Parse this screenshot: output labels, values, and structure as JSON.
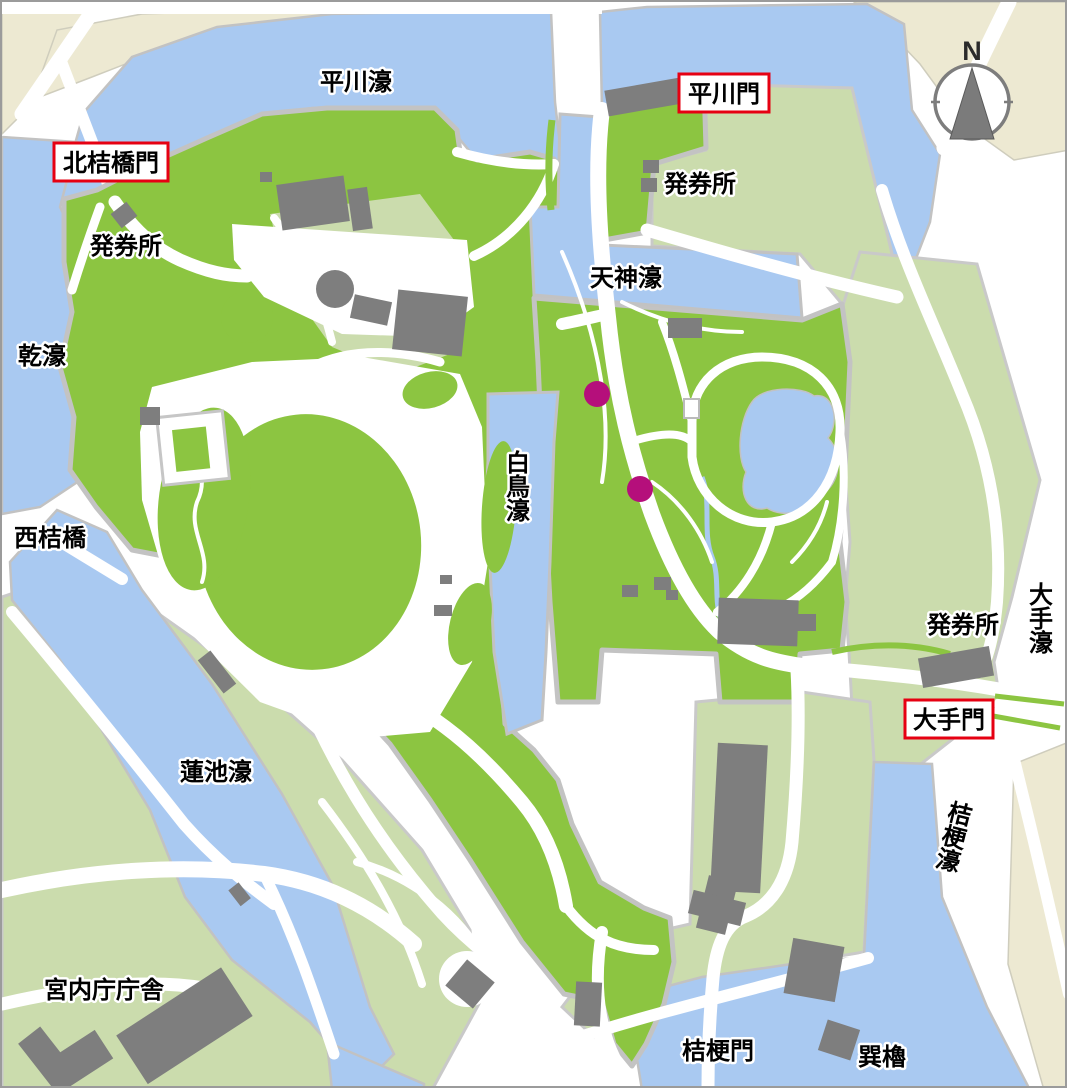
{
  "labels": {
    "hirakawa_moat": "平川濠",
    "hirakawa_gate": "平川門",
    "kitahanebashi_gate": "北桔橋門",
    "ticket_office_nw": "発券所",
    "ticket_office_ne": "発券所",
    "ticket_office_se": "発券所",
    "tenjin_moat": "天神濠",
    "inui_moat": "乾濠",
    "hakucho_moat": "白鳥濠",
    "nishihanebashi": "西桔橋",
    "ote_moat": "大手濠",
    "ote_gate": "大手門",
    "kikyo_moat": "桔梗濠",
    "hasuike_moat": "蓮池濠",
    "kunaicho_building": "宮内庁庁舎",
    "kikyo_gate": "桔梗門",
    "tatsumi_yagura": "巽櫓",
    "compass_north": "N"
  },
  "markers": {
    "garden_points": [
      {
        "x": 595,
        "y": 392
      },
      {
        "x": 638,
        "y": 487
      }
    ],
    "marker_color": "#B50F7B"
  },
  "colors": {
    "water": "#A9C9F1",
    "park_green": "#8CC541",
    "pale_green": "#CBDCAD",
    "beige": "#EDE9D2",
    "building_gray": "#7E7E7E",
    "wall_gray": "#C6C6C6",
    "path_white": "#FFFFFF",
    "gate_box_border": "#E60012"
  }
}
